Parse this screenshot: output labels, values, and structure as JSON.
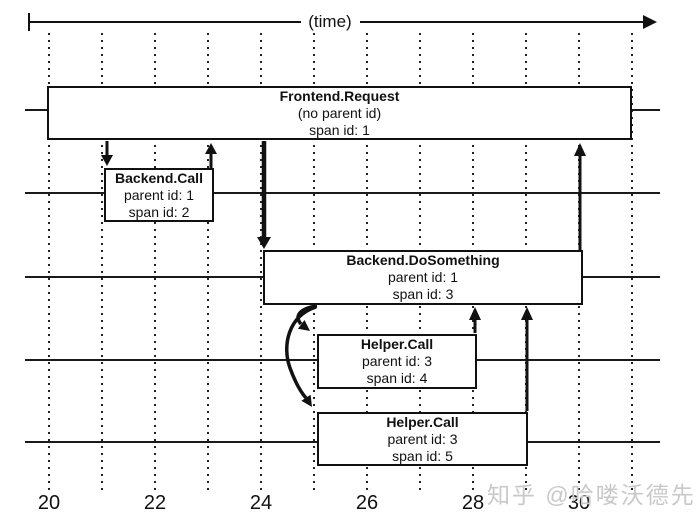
{
  "axis": {
    "time_label": "(time)",
    "ticks": [
      "20",
      "22",
      "24",
      "26",
      "28",
      "30"
    ],
    "gridline_values": [
      20,
      21,
      22,
      23,
      24,
      25,
      26,
      27,
      28,
      29,
      30,
      31
    ]
  },
  "spans": [
    {
      "name": "Frontend.Request",
      "parent": "(no parent id)",
      "span": "span id: 1",
      "start": 20,
      "end": 31
    },
    {
      "name": "Backend.Call",
      "parent": "parent id: 1",
      "span": "span id: 2",
      "start": 21,
      "end": 23
    },
    {
      "name": "Backend.DoSomething",
      "parent": "parent id: 1",
      "span": "span id: 3",
      "start": 24,
      "end": 30
    },
    {
      "name": "Helper.Call",
      "parent": "parent id: 3",
      "span": "span id: 4",
      "start": 25,
      "end": 28
    },
    {
      "name": "Helper.Call",
      "parent": "parent id: 3",
      "span": "span id: 5",
      "start": 25,
      "end": 29
    }
  ],
  "watermark": {
    "text": "知乎 @哈喽沃德先生",
    "color": "#c9c9c9"
  },
  "colors": {
    "line": "#111111",
    "background": "#ffffff",
    "gridline": "#222222"
  }
}
